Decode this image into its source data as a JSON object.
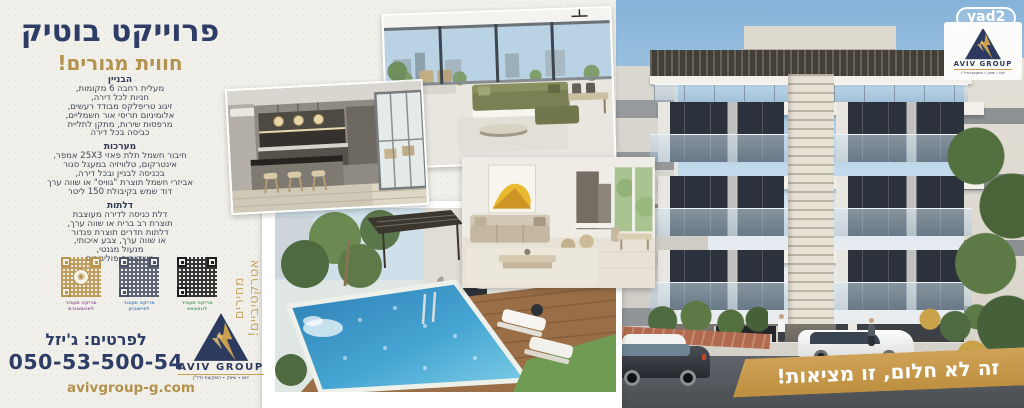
{
  "header": {
    "title": "פרוייקט בוטיק",
    "subtitle": "חווית מגורים!"
  },
  "specs": {
    "building": {
      "heading": "הבניין",
      "lines": [
        "מעלית רחבה 6 מקומות,",
        "חניות לכל דירה,",
        "זיגוג טריפלקס מבודד רעשים,",
        "אלומיניום תריסי אור חשמליים,",
        "מרפסות שירות, מתקן לתליית",
        "כביסה בכל דירה"
      ]
    },
    "systems": {
      "heading": "מערכות",
      "lines": [
        "חיבור חשמל תלת פאזי 25X3 אמפר,",
        "אינטרקום, טלוויזיה במעגל סגור",
        "בכניסה לבניין ובכל דירה,",
        "אביזרי חשמל תוצרת \"גוויס\" או שווה ערך",
        "דוד שמש בקיבולת 150 ליטר"
      ]
    },
    "doors": {
      "heading": "דלתות",
      "lines": [
        "דלת כניסה לדירה מעוצבת",
        "תוצרת רב בריח או שווה ערך,",
        "דלתות חדרים תוצרת פנדור",
        "או שווה ערך, צבע איכותי,",
        "מנעול מגנטי,",
        "משקופים פולימרים"
      ]
    }
  },
  "qr": {
    "instagram": {
      "line1": "סריקה תעביר",
      "line2": "לאינסטגרם",
      "color": "#9c6fa6"
    },
    "facebook": {
      "line1": "סריקה תעבור",
      "line2": "לפייסבוק",
      "color": "#5b8fc9"
    },
    "whatsapp": {
      "line1": "סריקה תעביר",
      "line2": "לוואצאפ",
      "color": "#5fa871"
    }
  },
  "contact": {
    "label": "לפרטים: ג'יזל",
    "phone": "050-53-500-54",
    "website": "avivgroup-g.com"
  },
  "side_note": {
    "line1": "מחירים",
    "line2": "אטרקטיביים!"
  },
  "slogan": "זה לא חלום, זו מציאות!",
  "brand": {
    "name": "AVIV GROUP",
    "tagline": "יזום ∙ שיווק ∙ השקעות נדל\"ן",
    "partner": "yad2"
  },
  "colors": {
    "navy": "#2d3d66",
    "gold": "#b3924d",
    "banner_gold": "#c89a4a"
  }
}
